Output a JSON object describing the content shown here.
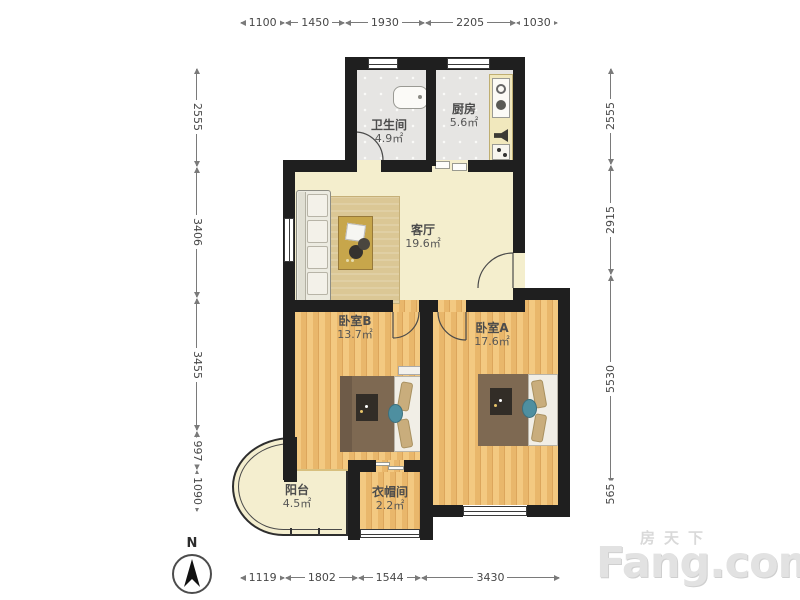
{
  "watermark": {
    "brand_cn": "房天下",
    "brand_en": "Fang.com"
  },
  "compass": {
    "label": "N"
  },
  "dimensions": {
    "top": [
      1100,
      1450,
      1930,
      2205,
      1030
    ],
    "bottom": [
      1119,
      1802,
      1544,
      3430
    ],
    "left": [
      2555,
      3406,
      3455,
      997,
      1090
    ],
    "right": [
      2555,
      2915,
      5530,
      565
    ]
  },
  "rooms": [
    {
      "name": "卫生间",
      "area": "4.9㎡"
    },
    {
      "name": "厨房",
      "area": "5.6㎡"
    },
    {
      "name": "客厅",
      "area": "19.6㎡"
    },
    {
      "name": "卧室B",
      "area": "13.7㎡"
    },
    {
      "name": "卧室A",
      "area": "17.6㎡"
    },
    {
      "name": "阳台",
      "area": "4.5㎡"
    },
    {
      "name": "衣帽间",
      "area": "2.2㎡"
    }
  ],
  "colors": {
    "wall": "#1f1f1f",
    "wood_floor": "#efc078",
    "tile_floor": "#e6e5e3",
    "cream_floor": "#f4eecd",
    "dimension_text": "#474747",
    "watermark": "#e2e2e2"
  }
}
